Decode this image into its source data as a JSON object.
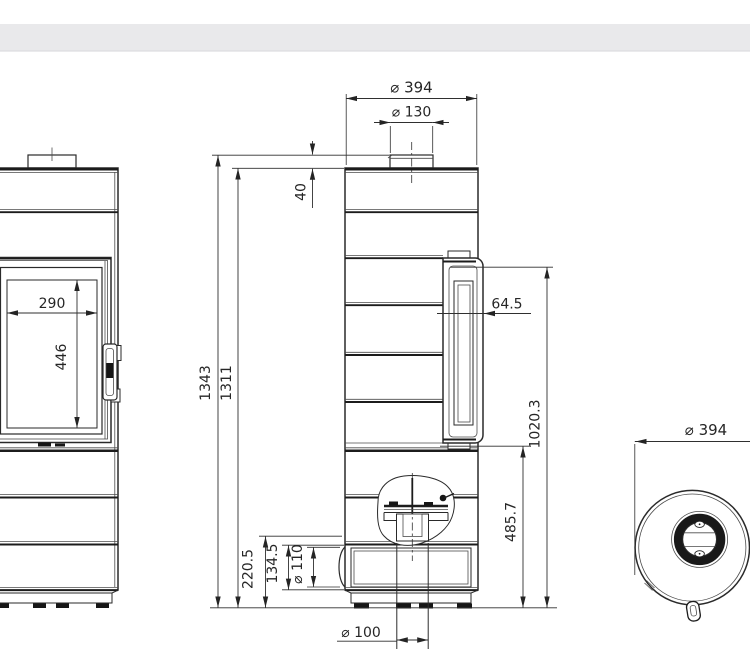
{
  "page": {
    "background": "#ffffff",
    "header_band_color": "#e9e9eb",
    "header_band_edge_color": "#dcdcdf",
    "line_color": "#2a2a2a"
  },
  "drawing": {
    "kind": "stove-dimension-drawing",
    "views": {
      "front": "front-view",
      "side": "side-view",
      "top": "top-view"
    },
    "dimensions": {
      "front": {
        "glass_width": "290",
        "glass_height": "446"
      },
      "side": {
        "outer_diameter": "⌀ 394",
        "flue_diameter": "⌀ 130",
        "collar_height": "40",
        "total_height": "1343",
        "body_height": "1311",
        "door_projection": "64.5",
        "door_top_from_floor": "1020.3",
        "door_bottom_from_floor": "485.7",
        "inlet_zone_height": "220.5",
        "base_opening_height": "134.5",
        "side_inlet_diameter": "⌀ 110",
        "bottom_inlet_diameter": "⌀ 100"
      },
      "top": {
        "outer_diameter": "⌀ 394"
      }
    }
  }
}
